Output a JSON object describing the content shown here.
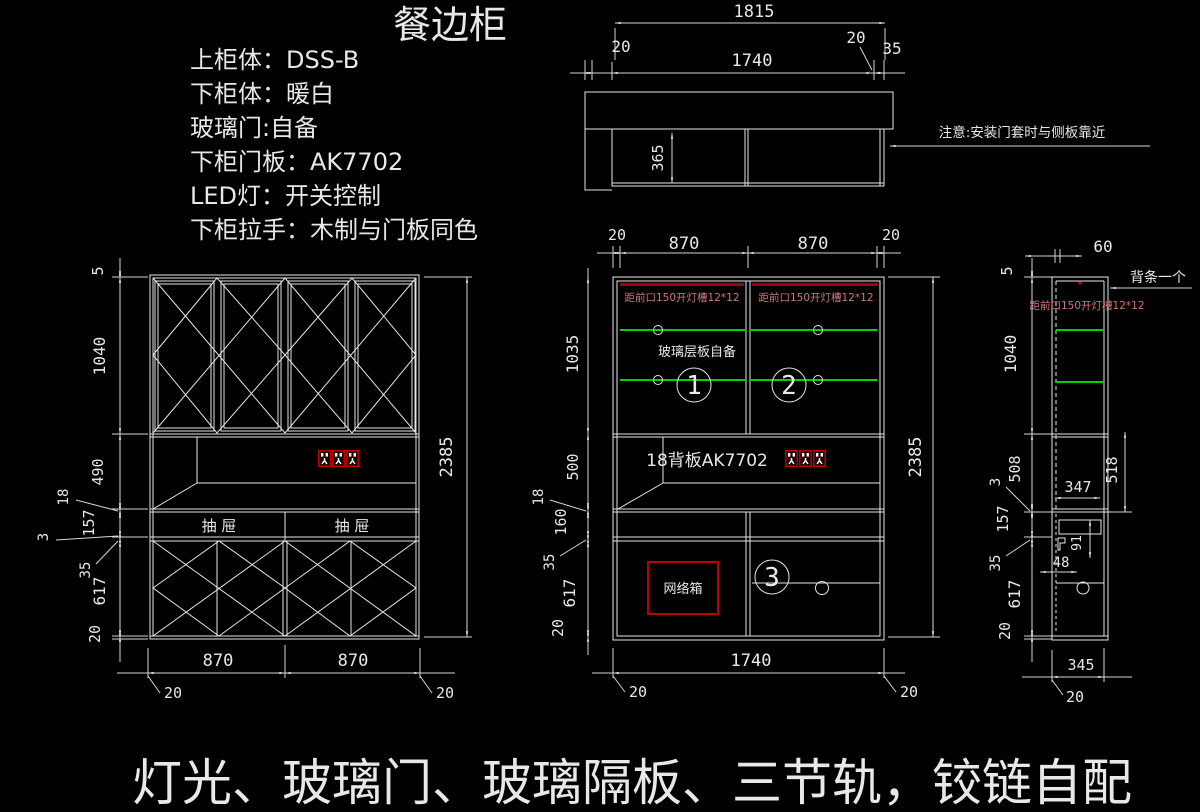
{
  "title": "餐边柜",
  "specs": [
    "上柜体：DSS-B",
    "下柜体：暖白",
    "玻璃门:自备",
    "下柜门板：AK7702",
    "LED灯：开关控制",
    "下柜拉手：木制与门板同色"
  ],
  "footer": "灯光、玻璃门、玻璃隔板、三节轨，铰链自配",
  "colors": {
    "background": "#000000",
    "line": "#e6e6e6",
    "glass_hatch": "#2ab5b5",
    "shelf_green": "#00d200",
    "red": "#c00000",
    "red_text": "#c87a7a"
  },
  "top_view": {
    "note": "注意:安装门套时与侧板靠近",
    "d_1815": "1815",
    "d_20l": "20",
    "d_1740": "1740",
    "d_20r": "20",
    "d_35": "35",
    "d_365": "365"
  },
  "front_view": {
    "d_5": "5",
    "d_1040": "1040",
    "d_490": "490",
    "d_18": "18",
    "d_157": "157",
    "d_3": "3",
    "d_35": "35",
    "d_617": "617",
    "d_20": "20",
    "d_2385": "2385",
    "d_870a": "870",
    "d_870b": "870",
    "d_20bl": "20",
    "d_20br": "20",
    "drawer_left": "抽 屉",
    "drawer_right": "抽 屉"
  },
  "mid_view": {
    "d_20l": "20",
    "d_870a": "870",
    "d_870b": "870",
    "d_20r": "20",
    "d_1035": "1035",
    "d_500": "500",
    "d_18": "18",
    "d_160": "160",
    "d_35": "35",
    "d_617": "617",
    "d_20b": "20",
    "d_2385": "2385",
    "d_1740": "1740",
    "d_20bl": "20",
    "d_20br": "20",
    "lamp_note": "距前口150开灯槽12*12",
    "glass_note": "玻璃层板自备",
    "n1": "1",
    "n2": "2",
    "n3": "3",
    "back_label": "18背板AK7702",
    "network_label": "网络箱"
  },
  "side_view": {
    "d_60": "60",
    "d_5": "5",
    "d_1040": "1040",
    "d_508": "508",
    "d_3": "3",
    "d_157": "157",
    "d_35": "35",
    "d_617": "617",
    "d_20": "20",
    "d_347": "347",
    "d_518": "518",
    "d_91": "91",
    "d_48": "48",
    "d_345": "345",
    "d_20b": "20",
    "strip_note": "背条一个",
    "lamp_note": "距前口150开灯槽12*12"
  }
}
